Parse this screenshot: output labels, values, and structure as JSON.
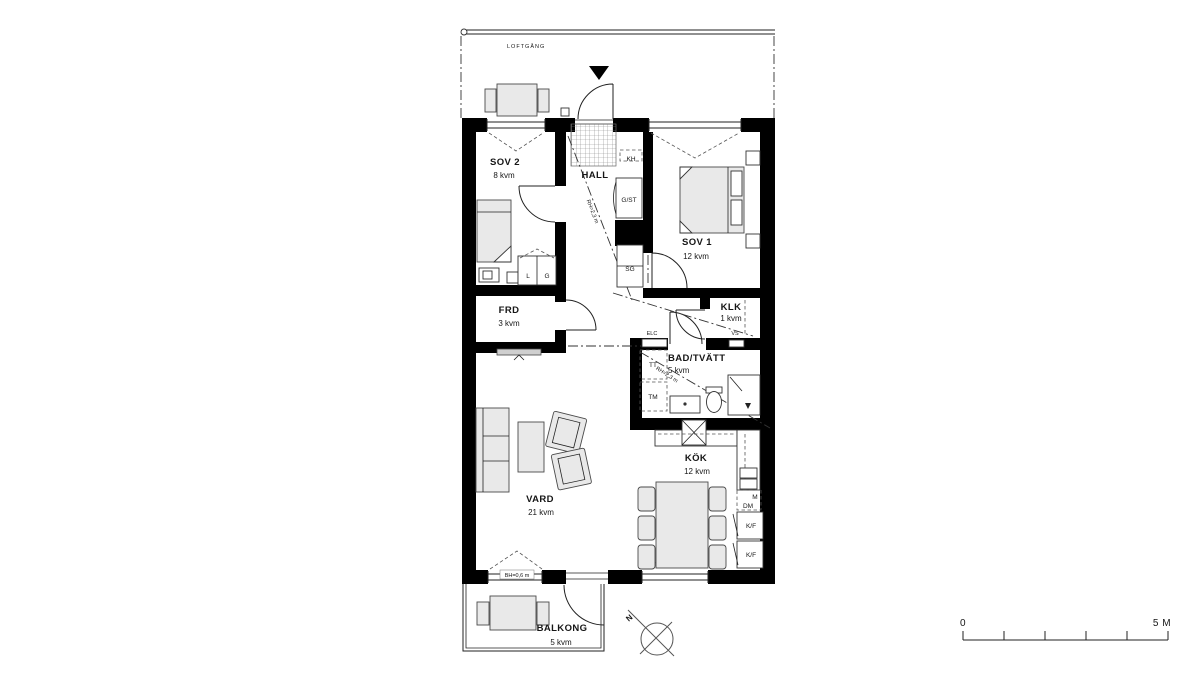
{
  "colors": {
    "wall": "#000000",
    "line": "#222222",
    "furniture_fill": "#e9e9e9",
    "background": "#ffffff"
  },
  "walkway": {
    "label": "LOFTGÅNG"
  },
  "rooms": {
    "sov2": {
      "name": "SOV 2",
      "area": "8 kvm"
    },
    "hall": {
      "name": "HALL"
    },
    "sov1": {
      "name": "SOV 1",
      "area": "12 kvm"
    },
    "frd": {
      "name": "FRD",
      "area": "3 kvm"
    },
    "klk": {
      "name": "KLK",
      "area": "1 kvm"
    },
    "bad": {
      "name": "BAD/TVÄTT",
      "area": "5 kvm"
    },
    "kok": {
      "name": "KÖK",
      "area": "12 kvm"
    },
    "vard": {
      "name": "VARD",
      "area": "21 kvm"
    },
    "balkong": {
      "name": "BALKONG",
      "area": "5 kvm"
    }
  },
  "fixtures": {
    "coat_hook": "KH",
    "cleaning_closet": "G/ST",
    "sliding_wardrobe": "SG",
    "linen_closet": "L",
    "wardrobe": "G",
    "dryer": "TT",
    "washer": "TM",
    "microwave": "M",
    "dishwasher": "DM",
    "fridge_freezer_top": "K/F",
    "fridge_freezer_bottom": "K/F",
    "electrical_cabinet": "ELC",
    "water_shutoff": "VS"
  },
  "annotations": {
    "ceiling_height": "RH=2,3 m",
    "sill_height": "BH=0,6 m",
    "north": "N"
  },
  "scalebar": {
    "start": "0",
    "end": "5 M"
  }
}
